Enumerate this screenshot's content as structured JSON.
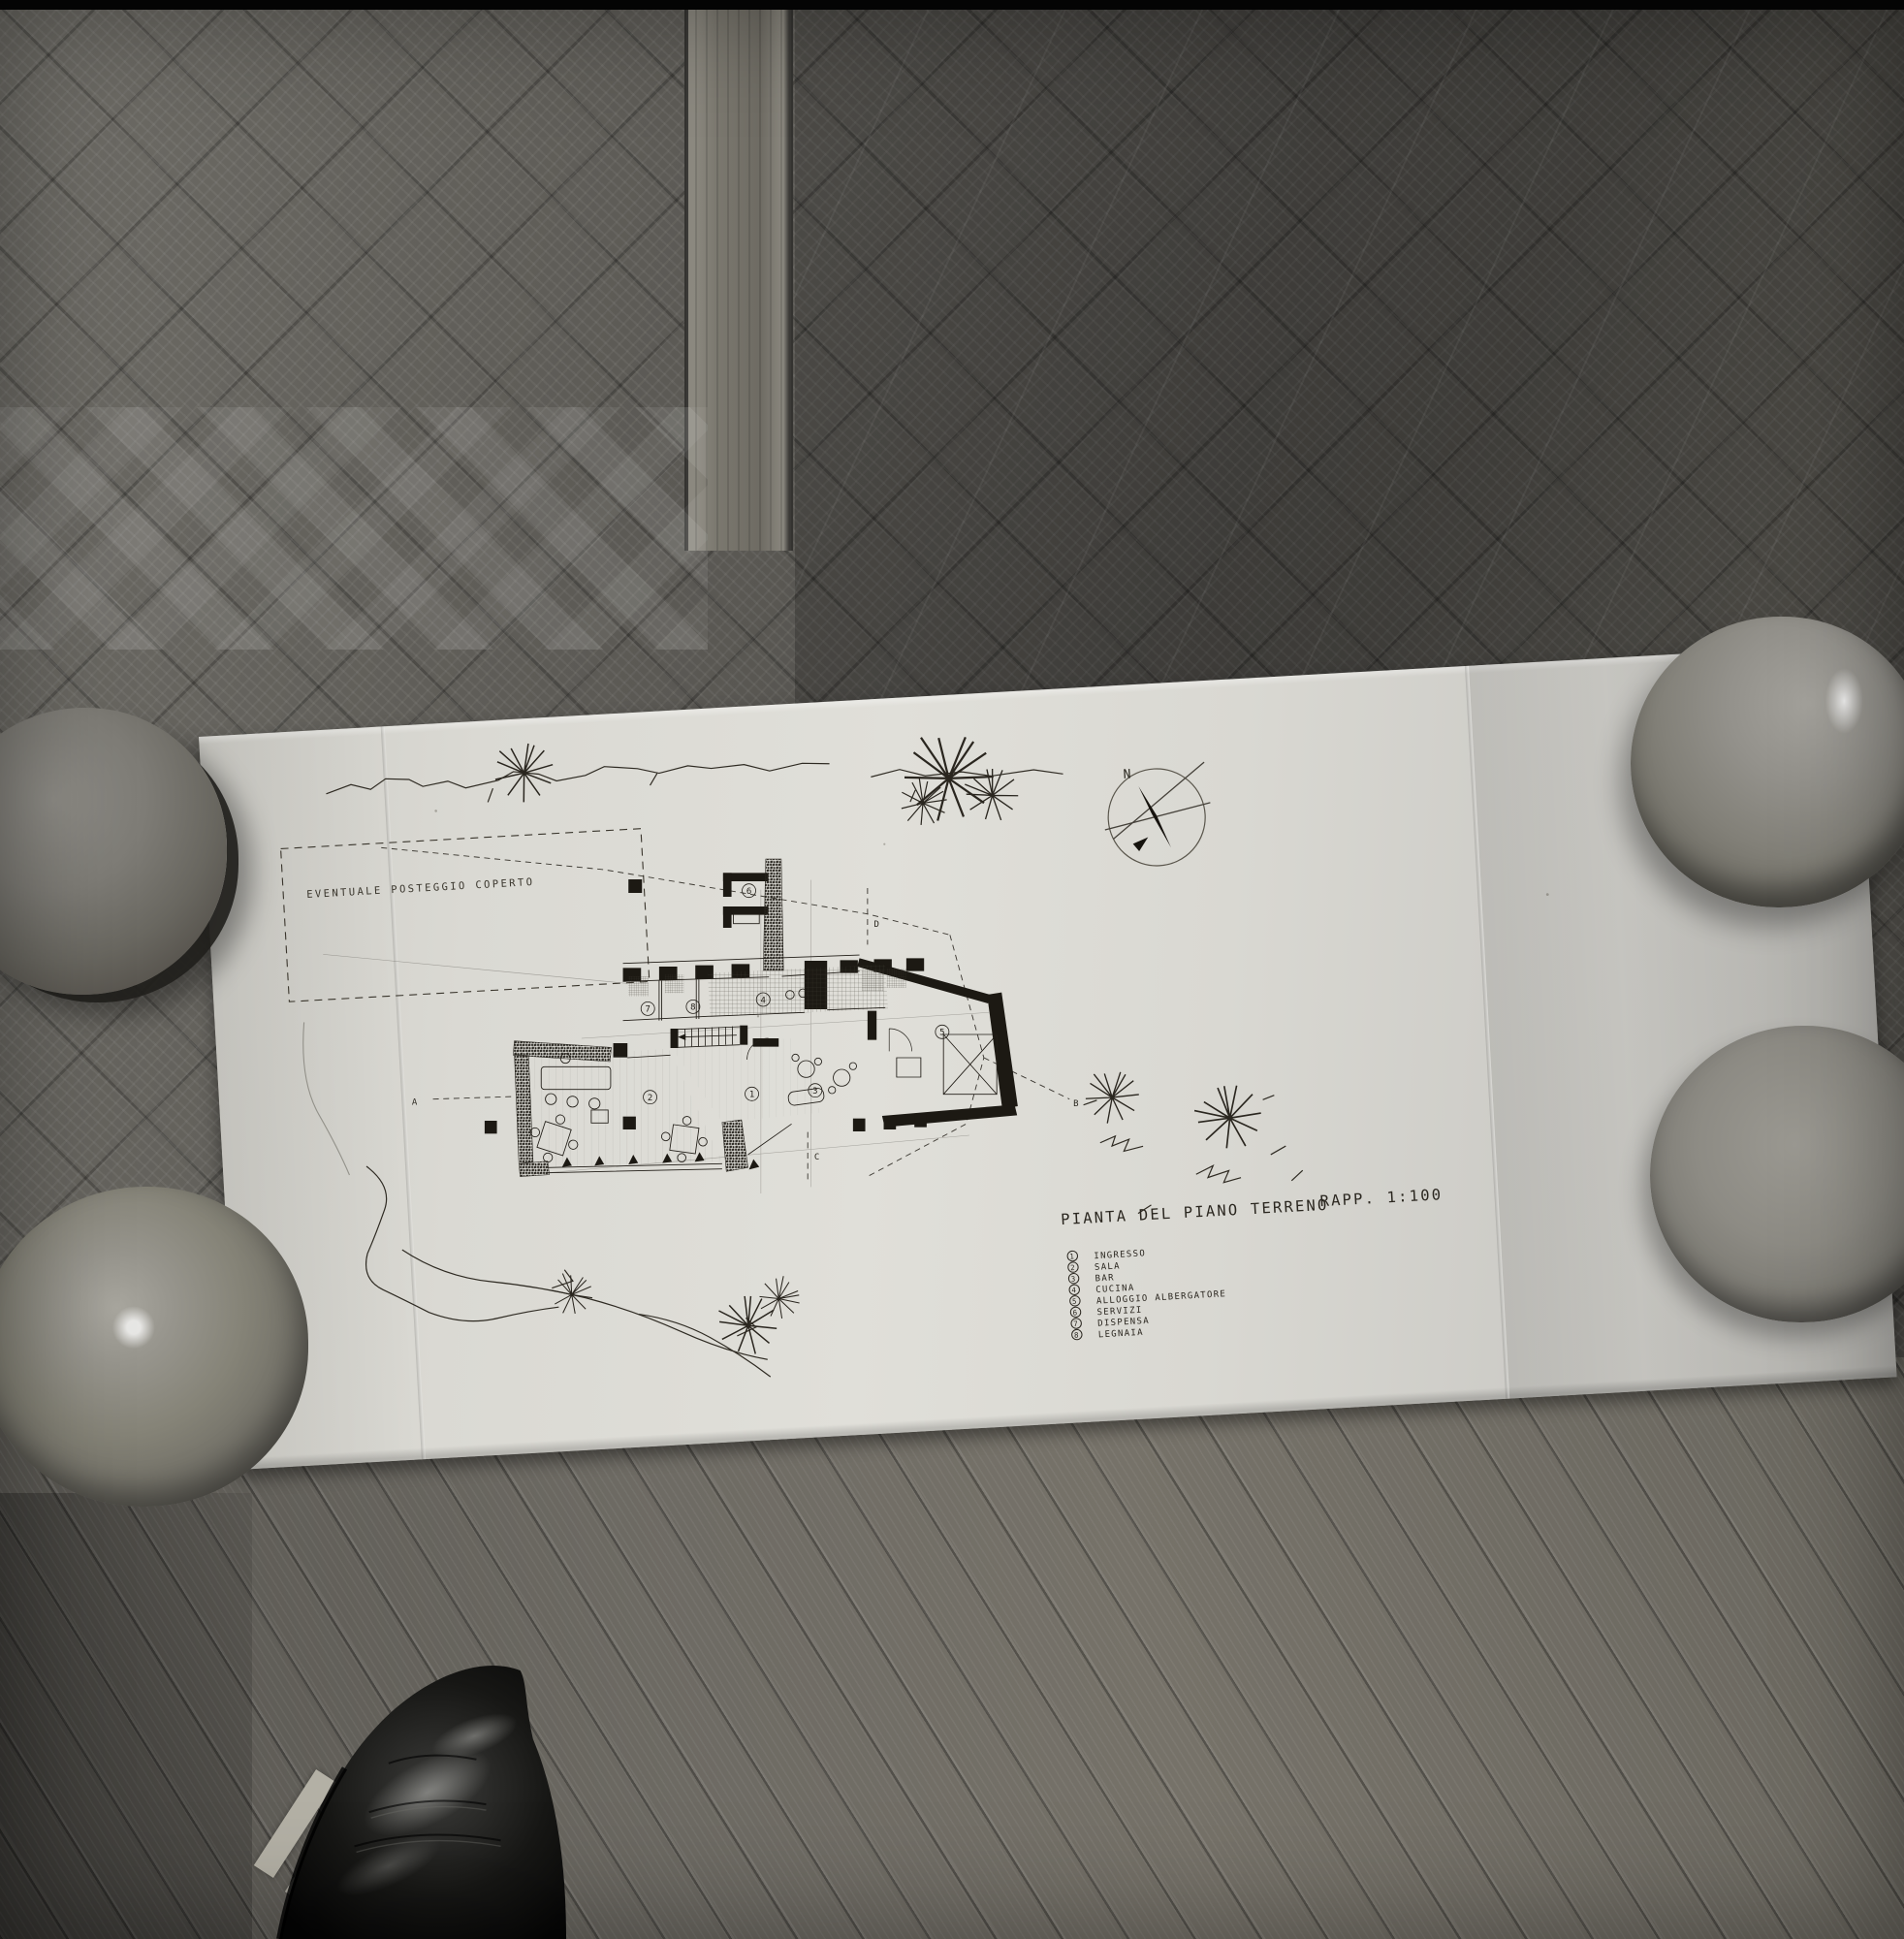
{
  "drawing": {
    "title_main": "PIANTA DEL PIANO TERRENO",
    "title_scale": "RAPP. 1:100",
    "site_label": "EVENTUALE POSTEGGIO COPERTO",
    "compass_north_label": "N",
    "section_markers": {
      "a": "A",
      "b": "B",
      "c": "C",
      "d": "D"
    },
    "room_numbers": {
      "ingresso": "1",
      "sala": "2",
      "bar": "3",
      "cucina": "4",
      "alloggio_albergatore": "5",
      "servizi": "6",
      "dispensa": "7",
      "legnaia": "8"
    },
    "legend": [
      {
        "num": "1",
        "label": "INGRESSO"
      },
      {
        "num": "2",
        "label": "SALA"
      },
      {
        "num": "3",
        "label": "BAR"
      },
      {
        "num": "4",
        "label": "CUCINA"
      },
      {
        "num": "5",
        "label": "ALLOGGIO ALBERGATORE"
      },
      {
        "num": "6",
        "label": "SERVIZI"
      },
      {
        "num": "7",
        "label": "DISPENSA"
      },
      {
        "num": "8",
        "label": "LEGNAIA"
      }
    ],
    "colors": {
      "paper": "#d9d8d2",
      "ink": "#262319",
      "floor_dark": "#504e4a",
      "floor_light": "#767269"
    }
  }
}
